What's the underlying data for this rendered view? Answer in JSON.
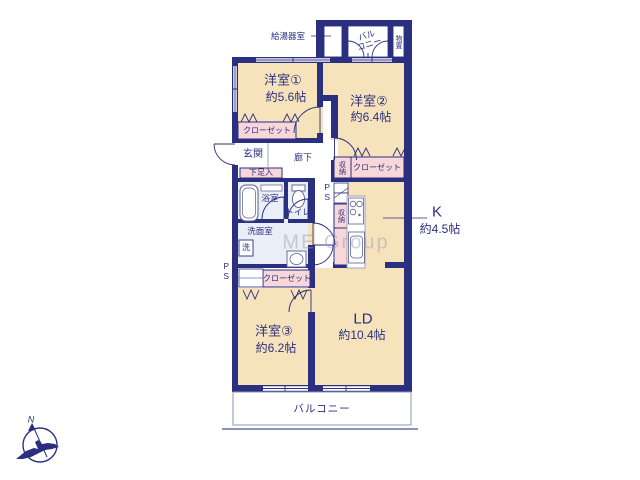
{
  "rooms": {
    "room1": {
      "name": "洋室①",
      "size": "約5.6帖"
    },
    "room2": {
      "name": "洋室②",
      "size": "約6.4帖"
    },
    "room3": {
      "name": "洋室③",
      "size": "約6.2帖"
    },
    "living_dining": {
      "name": "LD",
      "size": "約10.4帖"
    },
    "kitchen": {
      "name": "K",
      "size": "約4.5帖"
    }
  },
  "features": {
    "closet_room1": "クローゼット",
    "closet_room2": "クローゼット",
    "closet_room3": "クローゼット",
    "storage_hall": "収納",
    "storage_kitchen": "収納",
    "entrance": "玄関",
    "hallway": "廊下",
    "shoe_cabinet": "下足入",
    "bathroom": "浴室",
    "toilet": "トイレ",
    "washroom": "洗面室",
    "washer": "洗",
    "pipe_space_center": "PS",
    "pipe_space_left": "PS",
    "water_heater_room": "給湯器室",
    "storeroom": "物置",
    "balcony_top": {
      "line1": "バル",
      "line2": "コニー"
    },
    "balcony_bottom": "バルコニー"
  },
  "compass": {
    "north_label": "N"
  },
  "watermark": {
    "text": "ME Group"
  },
  "colors": {
    "wall": "#2b2f80",
    "room_fill": "#f6e3bc",
    "closet_fill": "#f7d7d9",
    "wet_area_fill": "#e9eef7",
    "balcony_line": "#8d92b8",
    "text": "#2b2f80",
    "watermark": "#9499b2"
  }
}
